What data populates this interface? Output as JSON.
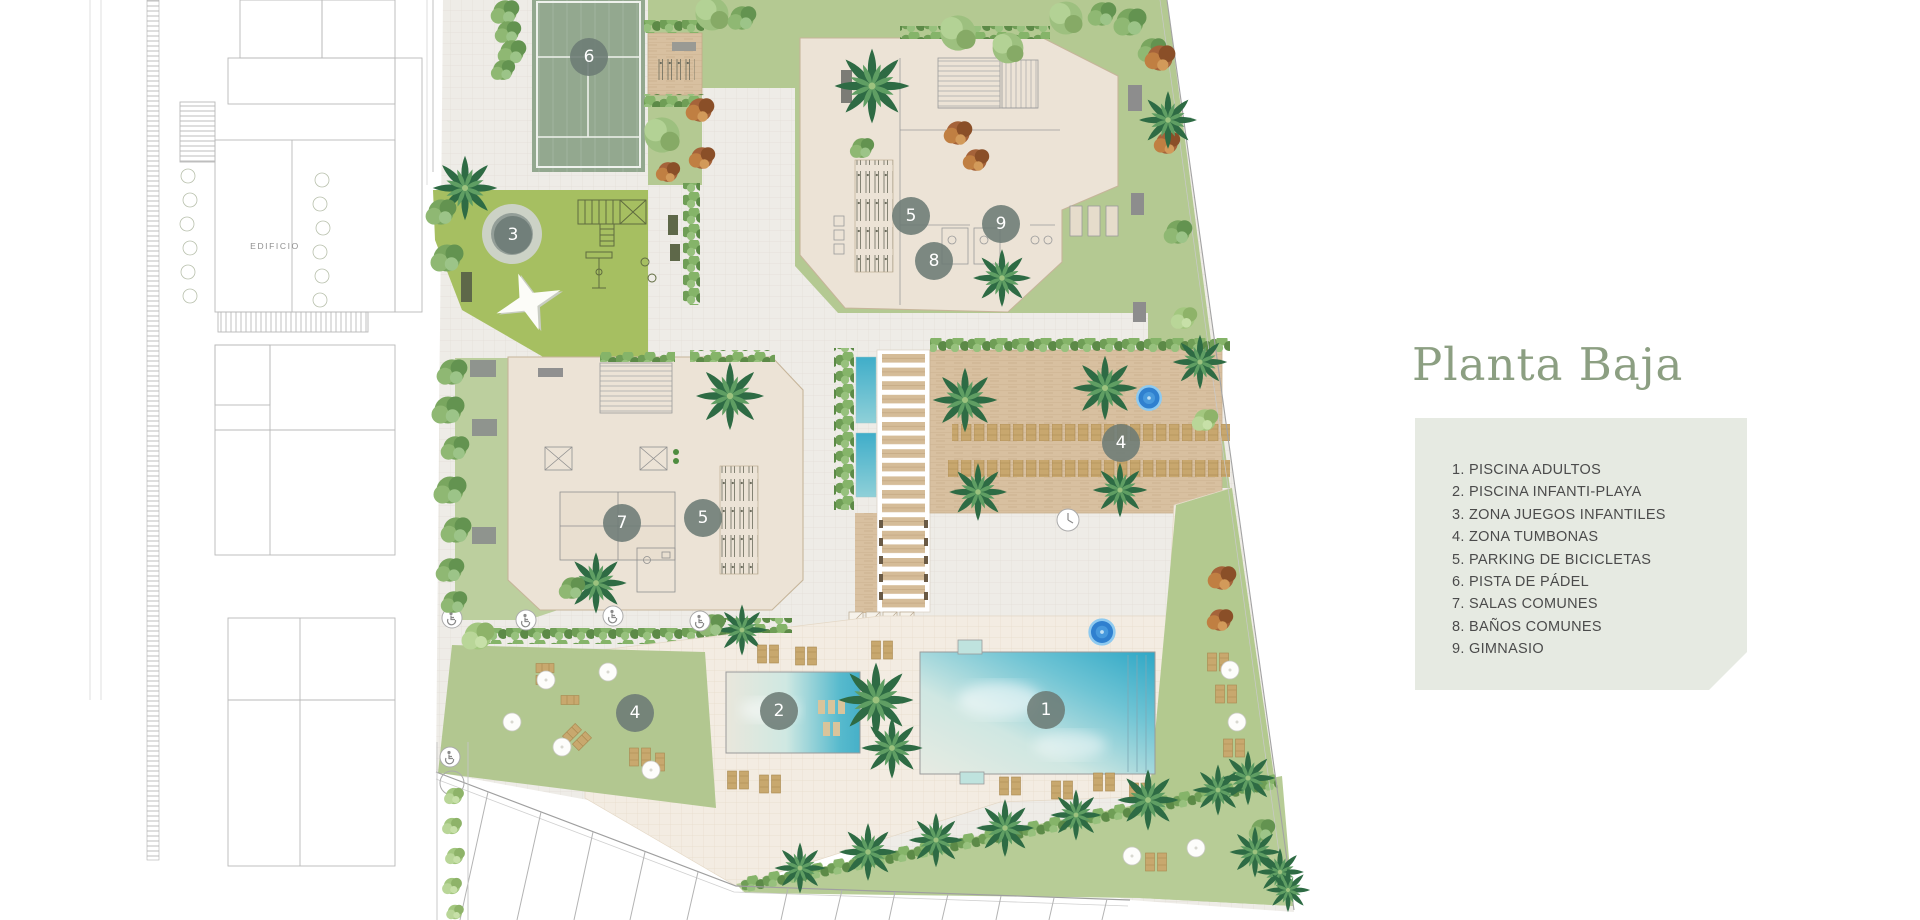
{
  "plan_title": "Planta Baja",
  "legend": {
    "items": [
      "1. PISCINA ADULTOS",
      "2. PISCINA INFANTI-PLAYA",
      "3. ZONA JUEGOS INFANTILES",
      "4. ZONA TUMBONAS",
      "5. PARKING DE BICICLETAS",
      "6. PISTA DE PÁDEL",
      "7. SALAS COMUNES",
      "8. BAÑOS COMUNES",
      "9. GIMNASIO"
    ]
  },
  "plan": {
    "neighbor_building_label": "EDIFICIO",
    "markers": [
      {
        "n": "6",
        "x": 589,
        "y": 57
      },
      {
        "n": "3",
        "x": 513,
        "y": 235
      },
      {
        "n": "5",
        "x": 911,
        "y": 216
      },
      {
        "n": "9",
        "x": 1001,
        "y": 224
      },
      {
        "n": "8",
        "x": 934,
        "y": 261
      },
      {
        "n": "7",
        "x": 622,
        "y": 523
      },
      {
        "n": "5",
        "x": 703,
        "y": 518
      },
      {
        "n": "4",
        "x": 1121,
        "y": 443
      },
      {
        "n": "4",
        "x": 635,
        "y": 713
      },
      {
        "n": "2",
        "x": 779,
        "y": 711
      },
      {
        "n": "1",
        "x": 1046,
        "y": 710
      }
    ]
  },
  "colors": {
    "title_green": "#8c9f82",
    "legend_bg": "#e6eae2",
    "legend_text": "#4b4b4b",
    "marker_fill": "#6c7b75",
    "lawn": "#b6cb97",
    "playground": "#a6bf61",
    "padel_court": "#93a88f",
    "building_cream": "#ece3d6",
    "wood_deck": "#d8c0a0",
    "pool_turquoise": "#4cb4cc",
    "spa_blue": "#2f80cf"
  }
}
